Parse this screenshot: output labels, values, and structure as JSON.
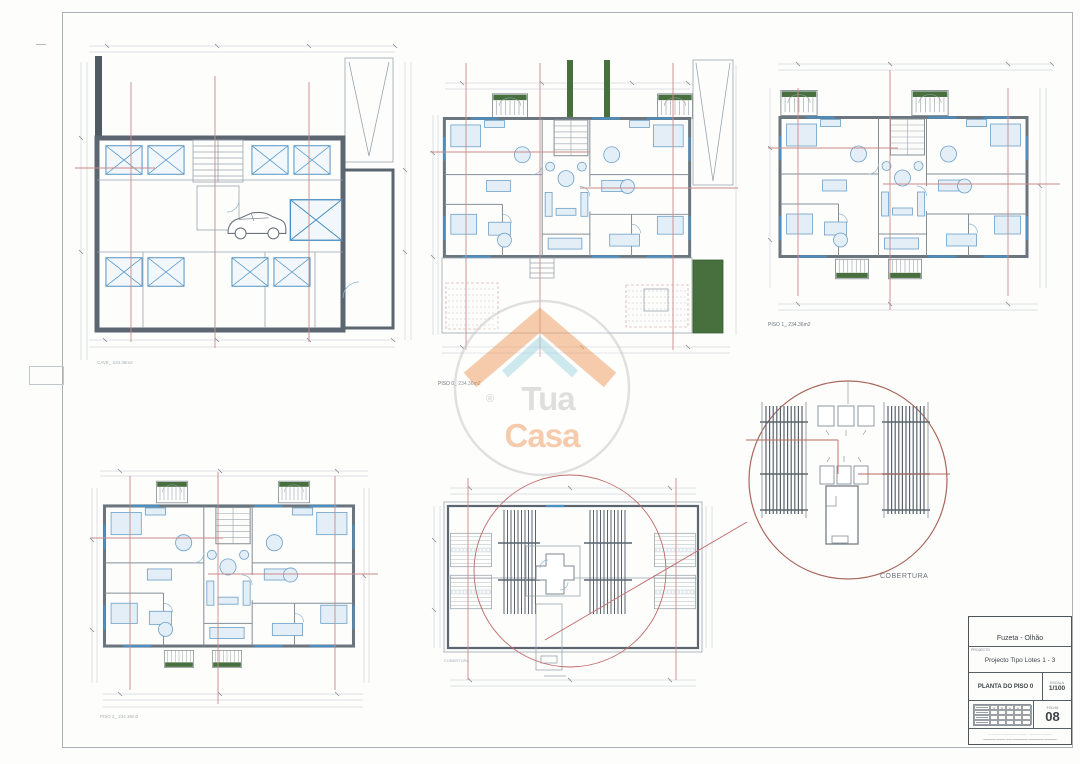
{
  "plans": {
    "cave": {
      "label": "CAVE_ 234.36m2"
    },
    "piso0": {
      "label": "PISO 0_ 234.36m2"
    },
    "piso1": {
      "label": "PISO 1_ 234.36m2"
    },
    "piso2": {
      "label": "PISO 2_ 234.36m2"
    },
    "cobertura": {
      "label": "COBERTURA"
    },
    "detail": {
      "label": "COBERTURA"
    }
  },
  "watermark": {
    "registered": "®",
    "brand_top": "Tua",
    "brand_bottom": "Casa"
  },
  "title_block": {
    "location": "Fuzeta - Olhão",
    "project_label": "PROJECTO",
    "project_name": "Projecto Tipo Lotes 1 - 3",
    "drawing_title": "PLANTA DO PISO 0",
    "scale_label": "ESCALA",
    "scale_value": "1/100",
    "sheet_label": "FOLHA",
    "sheet_number": "08",
    "revision_cells": [
      "4",
      "3",
      "1",
      "1"
    ],
    "fine_print_line1": "— ——— ————— ——— · ———— ———",
    "fine_print_line2": "———— ——— —— ————— ————— ————"
  },
  "colors": {
    "wall": "#5c6670",
    "fixtures_blue": "#4a90c4",
    "dimension_red": "#c98a8a",
    "garden_green": "#48703f",
    "logo_orange": "#f0a46a",
    "logo_teal": "#a9d9e2",
    "logo_gray": "#c6c6c6"
  }
}
